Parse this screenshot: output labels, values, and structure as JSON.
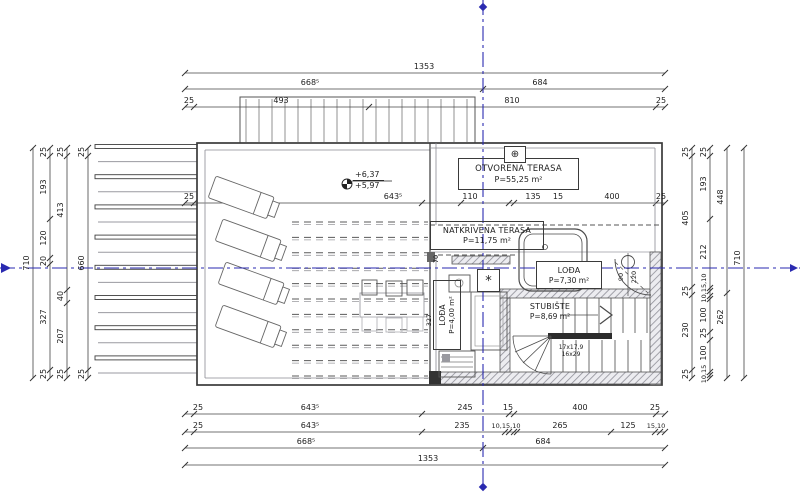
{
  "colors": {
    "axis_blue": "#2a2ab0",
    "line_dark": "#3a3a3a",
    "line_light": "#9a9aa0",
    "wall_hatch": "#8f8f98"
  },
  "rooms": {
    "otvorena_terasa": {
      "name": "OTVORENA TERASA",
      "area": "P=55,25 m²"
    },
    "natkrivena_terasa": {
      "name": "NATKRIVENA TERASA",
      "area": "P=11,75 m²"
    },
    "lodja_desno": {
      "name": "LOĐA",
      "area": "P=7,30 m²"
    },
    "lodja_lijevo": {
      "name": "LOĐA",
      "area": "P=4,00 m²"
    },
    "stubiste": {
      "name": "STUBIŠTE",
      "area": "P=8,69 m²"
    }
  },
  "annotations": {
    "level_upper": "+6,37",
    "level_lower": "+5,97",
    "stair_steps_1": "17x17,9",
    "stair_steps_2": "16x29",
    "door_width": "90",
    "door_height": "220",
    "star": "*",
    "roof_symbol": "⊕",
    "inner_dim_70": "70",
    "inner_dim_327": "327"
  },
  "dimensions": {
    "top_row1": [
      "1353"
    ],
    "top_row2": [
      "668⁵",
      "684"
    ],
    "top_row3": [
      "25",
      "493",
      "810",
      "25"
    ],
    "mid_row": [
      "25",
      "643⁵",
      "110",
      "135",
      "15",
      "400",
      "25"
    ],
    "bottom_row1": [
      "25",
      "643⁵",
      "245",
      "15",
      "400",
      "25"
    ],
    "bottom_row2": [
      "25",
      "643⁵",
      "235",
      "10,15,10",
      "265",
      "125",
      "15,10"
    ],
    "bottom_row3": [
      "668⁵",
      "684"
    ],
    "bottom_row4": [
      "1353"
    ],
    "left_col1": [
      "710"
    ],
    "left_col2": [
      "25",
      "193",
      "120",
      "20",
      "327",
      "25"
    ],
    "left_col3": [
      "25",
      "413",
      "40",
      "207",
      "25"
    ],
    "left_col4": [
      "25",
      "660",
      "25"
    ],
    "right_col1": [
      "25",
      "405",
      "25",
      "230",
      "25"
    ],
    "right_col2": [
      "25",
      "193",
      "212",
      "10,15,10",
      "100",
      "25",
      "100",
      "10,15"
    ],
    "right_col3": [
      "448",
      "262"
    ],
    "right_col4": [
      "710"
    ]
  }
}
